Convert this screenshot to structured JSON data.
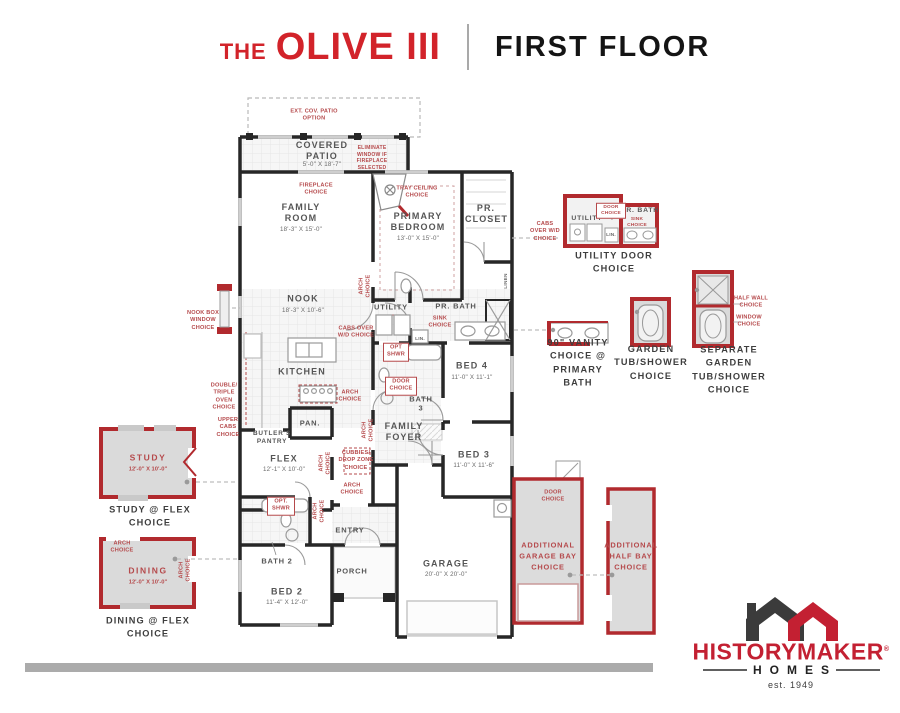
{
  "header": {
    "title_prefix": "THE",
    "title_name": "OLIVE III",
    "floor_label": "FIRST FLOOR"
  },
  "rooms": {
    "covered_patio": {
      "name": "COVERED PATIO",
      "dims": "5'-0\" X 18'-7\""
    },
    "family_room": {
      "name": "FAMILY ROOM",
      "dims": "18'-3\" X 15'-0\""
    },
    "primary_bedroom": {
      "name": "PRIMARY BEDROOM",
      "dims": "13'-0\" X 15'-0\""
    },
    "pr_closet": {
      "name": "PR. CLOSET"
    },
    "nook": {
      "name": "NOOK",
      "dims": "18'-3\" X 10'-6\""
    },
    "utility": {
      "name": "UTILITY"
    },
    "pr_bath": {
      "name": "PR. BATH"
    },
    "kitchen": {
      "name": "KITCHEN"
    },
    "pan": {
      "name": "PAN."
    },
    "butlers_pantry": {
      "name": "BUTLER'S PANTRY"
    },
    "flex": {
      "name": "FLEX",
      "dims": "12'-1\" X 10'-0\""
    },
    "bed4": {
      "name": "BED 4",
      "dims": "11'-0\" X 11'-1\""
    },
    "bath3": {
      "name": "BATH 3"
    },
    "family_foyer": {
      "name": "FAMILY FOYER"
    },
    "bed3": {
      "name": "BED 3",
      "dims": "11'-0\" X 11'-6\""
    },
    "bath2": {
      "name": "BATH 2"
    },
    "bed2": {
      "name": "BED 2",
      "dims": "11'-4\" X 12'-0\""
    },
    "entry": {
      "name": "ENTRY"
    },
    "porch": {
      "name": "PORCH"
    },
    "garage": {
      "name": "GARAGE",
      "dims": "20'-0\" X 20'-0\""
    },
    "lin": {
      "name": "LIN."
    },
    "linen": {
      "name": "LINEN"
    }
  },
  "options": {
    "ext_cov_patio": "EXT. COV. PATIO OPTION",
    "eliminate_window": "ELIMINATE WINDOW IF FIREPLACE SELECTED",
    "fireplace": "FIREPLACE CHOICE",
    "tray_ceiling": "TRAY CEILING CHOICE",
    "arch": "ARCH CHOICE",
    "door": "DOOR CHOICE",
    "sink": "SINK CHOICE",
    "cabs_over_wd": "CABS OVER W/D CHOICE",
    "opt_shwr": "OPT SHWR",
    "opt_shwr_alt": "OPT. SHWR",
    "cubbies": "CUBBIES/ DROP ZONE CHOICE",
    "double_triple_oven": "DOUBLE/ TRIPLE OVEN CHOICE",
    "upper_cabs": "UPPER CABS CHOICE",
    "nook_box_window": "NOOK BOX WINDOW CHOICE",
    "half_wall": "HALF WALL CHOICE",
    "window": "WINDOW CHOICE"
  },
  "callouts": {
    "study": {
      "name": "STUDY",
      "dims": "12'-0\" X 10'-0\"",
      "caption": "STUDY @ FLEX CHOICE"
    },
    "dining": {
      "name": "DINING",
      "dims": "12'-0\" X 10'-0\"",
      "caption": "DINING @ FLEX CHOICE"
    },
    "utility_door": {
      "caption": "UTILITY DOOR CHOICE"
    },
    "vanity": {
      "caption": "90\" VANITY CHOICE @ PRIMARY BATH"
    },
    "garden_tub": {
      "caption": "GARDEN TUB/SHOWER CHOICE"
    },
    "separate_garden_tub": {
      "caption": "SEPARATE GARDEN TUB/SHOWER CHOICE"
    },
    "additional_garage_bay": {
      "caption": "ADDITIONAL GARAGE BAY CHOICE"
    },
    "additional_half_bay": {
      "caption": "ADDITIONAL HALF BAY CHOICE"
    }
  },
  "logo": {
    "brand": "HISTORYMAKER",
    "registered": "®",
    "homes": "HOMES",
    "est": "est. 1949"
  },
  "colors": {
    "brand_red": "#D2232A",
    "callout_red": "#B5494B",
    "diagram_red": "#B12A2E",
    "wall": "#272727"
  }
}
